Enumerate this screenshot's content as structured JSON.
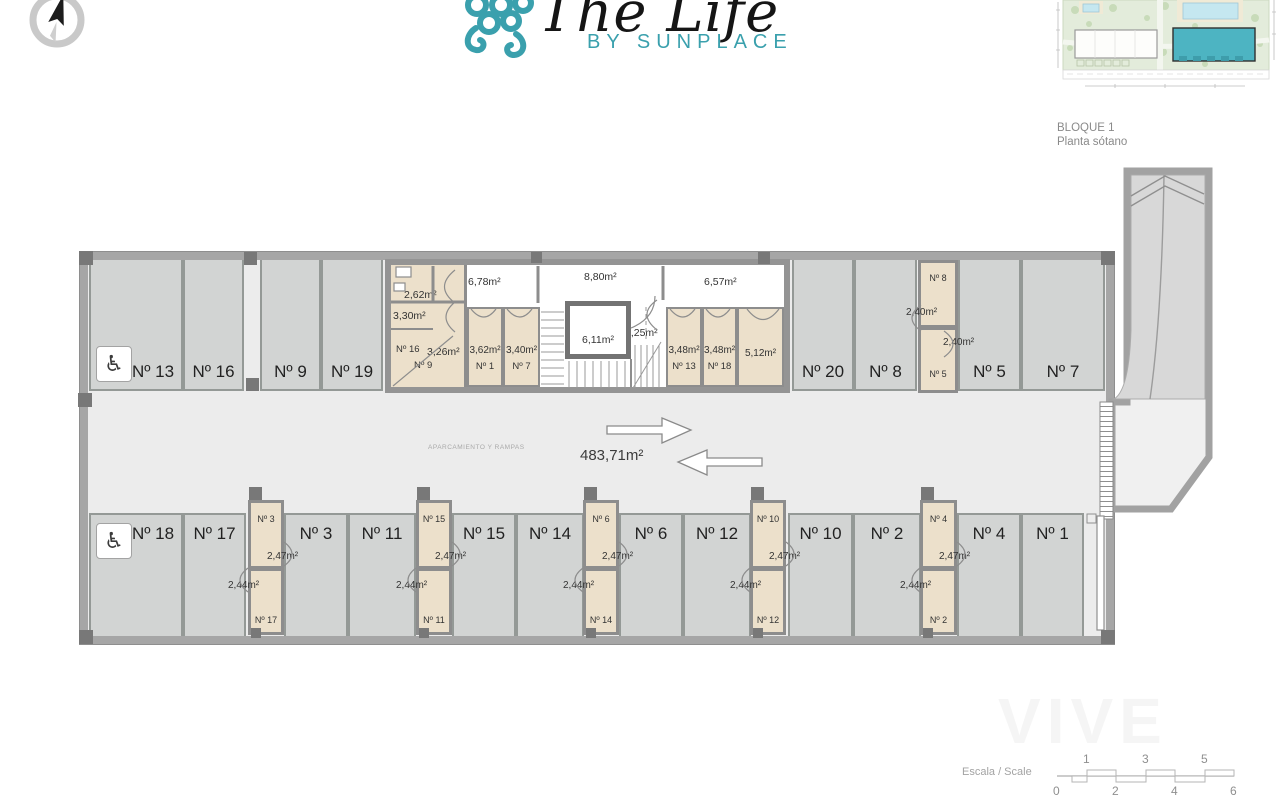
{
  "colors": {
    "teal": "#3aa0ad",
    "keyplan_building": "#4db4c2",
    "floor": "#ececec",
    "stall": "#d2d4d3",
    "storage": "#ece0cb",
    "wall": "#a6a6a6"
  },
  "icons": {
    "wheelchair": "♿",
    "compass": "compass-needle"
  },
  "logo": {
    "title": "The Life",
    "subtitle": "BY SUNPLACE"
  },
  "keyplan": {
    "block": "BLOQUE 1",
    "floor": "Planta sótano"
  },
  "plan": {
    "central": {
      "caption": "APARCAMIENTO Y RAMPAS",
      "area": "483,71m²"
    },
    "top_parking": [
      {
        "label": "Nº 13",
        "accessible": true
      },
      {
        "label": "Nº 16"
      },
      {
        "label": "Nº 9"
      },
      {
        "label": "Nº 19"
      },
      {
        "label": "Nº 20"
      },
      {
        "label": "Nº 8"
      },
      {
        "label": "Nº 5"
      },
      {
        "label": "Nº 7"
      }
    ],
    "bottom_parking": [
      {
        "label": "Nº 18",
        "accessible": true
      },
      {
        "label": "Nº 17"
      },
      {
        "label": "Nº 3"
      },
      {
        "label": "Nº 11"
      },
      {
        "label": "Nº 15"
      },
      {
        "label": "Nº 14"
      },
      {
        "label": "Nº 6"
      },
      {
        "label": "Nº 12"
      },
      {
        "label": "Nº 10"
      },
      {
        "label": "Nº 2"
      },
      {
        "label": "Nº 4"
      },
      {
        "label": "Nº 1"
      }
    ],
    "storage_top_column": {
      "top_label": "Nº 8",
      "top_area": "2,40m²",
      "bottom_label": "Nº 5",
      "bottom_area": "2,40m²"
    },
    "storage_columns": [
      {
        "top_label": "Nº 3",
        "top_area": "2,47m²",
        "bottom_label": "Nº 17",
        "bottom_area": "2,44m²"
      },
      {
        "top_label": "Nº 15",
        "top_area": "2,47m²",
        "bottom_label": "Nº 11",
        "bottom_area": "2,44m²"
      },
      {
        "top_label": "Nº 6",
        "top_area": "2,47m²",
        "bottom_label": "Nº 14",
        "bottom_area": "2,44m²"
      },
      {
        "top_label": "Nº 10",
        "top_area": "2,47m²",
        "bottom_label": "Nº 12",
        "bottom_area": "2,44m²"
      },
      {
        "top_label": "Nº 4",
        "top_area": "2,47m²",
        "bottom_label": "Nº 2",
        "bottom_area": "2,44m²"
      }
    ],
    "trastero_block": {
      "tech_area": "2,62m²",
      "area_330": "3,30m²",
      "num_16": "Nº 16",
      "area_326": "3,26m²",
      "num_9": "Nº 9",
      "corridor_1": "6,78m²",
      "corridor_2": "8,80m²",
      "corridor_3": "6,57m²",
      "lobby": "3,25m²",
      "lift": "6,11m²",
      "rooms": [
        {
          "area": "3,62m²",
          "label": "Nº 1"
        },
        {
          "area": "3,40m²",
          "label": "Nº 7"
        },
        {
          "area": "3,48m²",
          "label": "Nº 13"
        },
        {
          "area": "3,48m²",
          "label": "Nº 18"
        },
        {
          "area": "5,12m²",
          "label": ""
        }
      ]
    }
  },
  "scale": {
    "label": "Escala / Scale",
    "top_ticks": [
      "1",
      "3",
      "5"
    ],
    "bottom_ticks": [
      "0",
      "2",
      "4",
      "6"
    ]
  },
  "watermark": "VIVE"
}
